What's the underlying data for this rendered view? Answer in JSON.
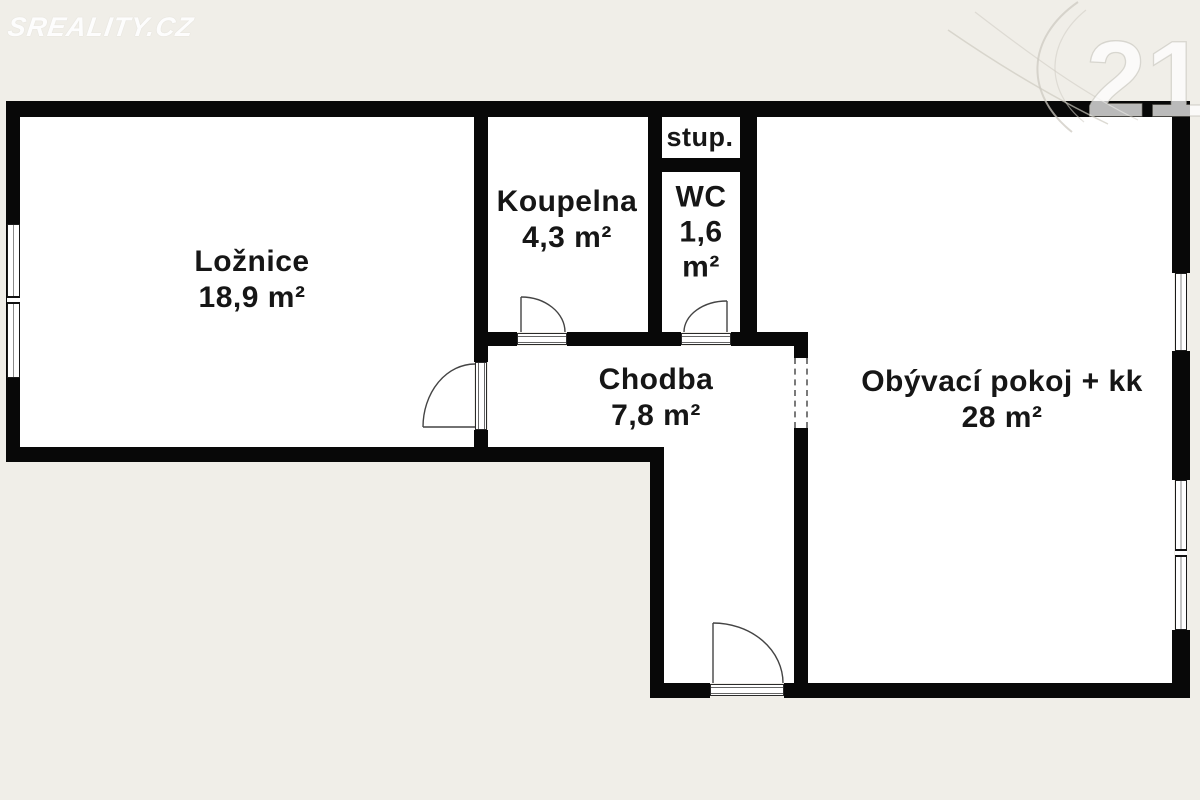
{
  "watermarks": {
    "sreality": "SREALITY.CZ",
    "century21": "21"
  },
  "rooms": {
    "loznice": {
      "name": "Ložnice",
      "area": "18,9 m²"
    },
    "koupelna": {
      "name": "Koupelna",
      "area": "4,3 m²"
    },
    "wc": {
      "name": "WC",
      "area_value": "1,6",
      "area_unit": "m²"
    },
    "stup": {
      "name": "stup."
    },
    "chodba": {
      "name": "Chodba",
      "area": "7,8 m²"
    },
    "obyvaci": {
      "name": "Obývací pokoj + kk",
      "area": "28 m²"
    }
  },
  "colors": {
    "background": "#f0eee8",
    "wall": "#080808",
    "floor": "#ffffff",
    "text": "#161616"
  }
}
